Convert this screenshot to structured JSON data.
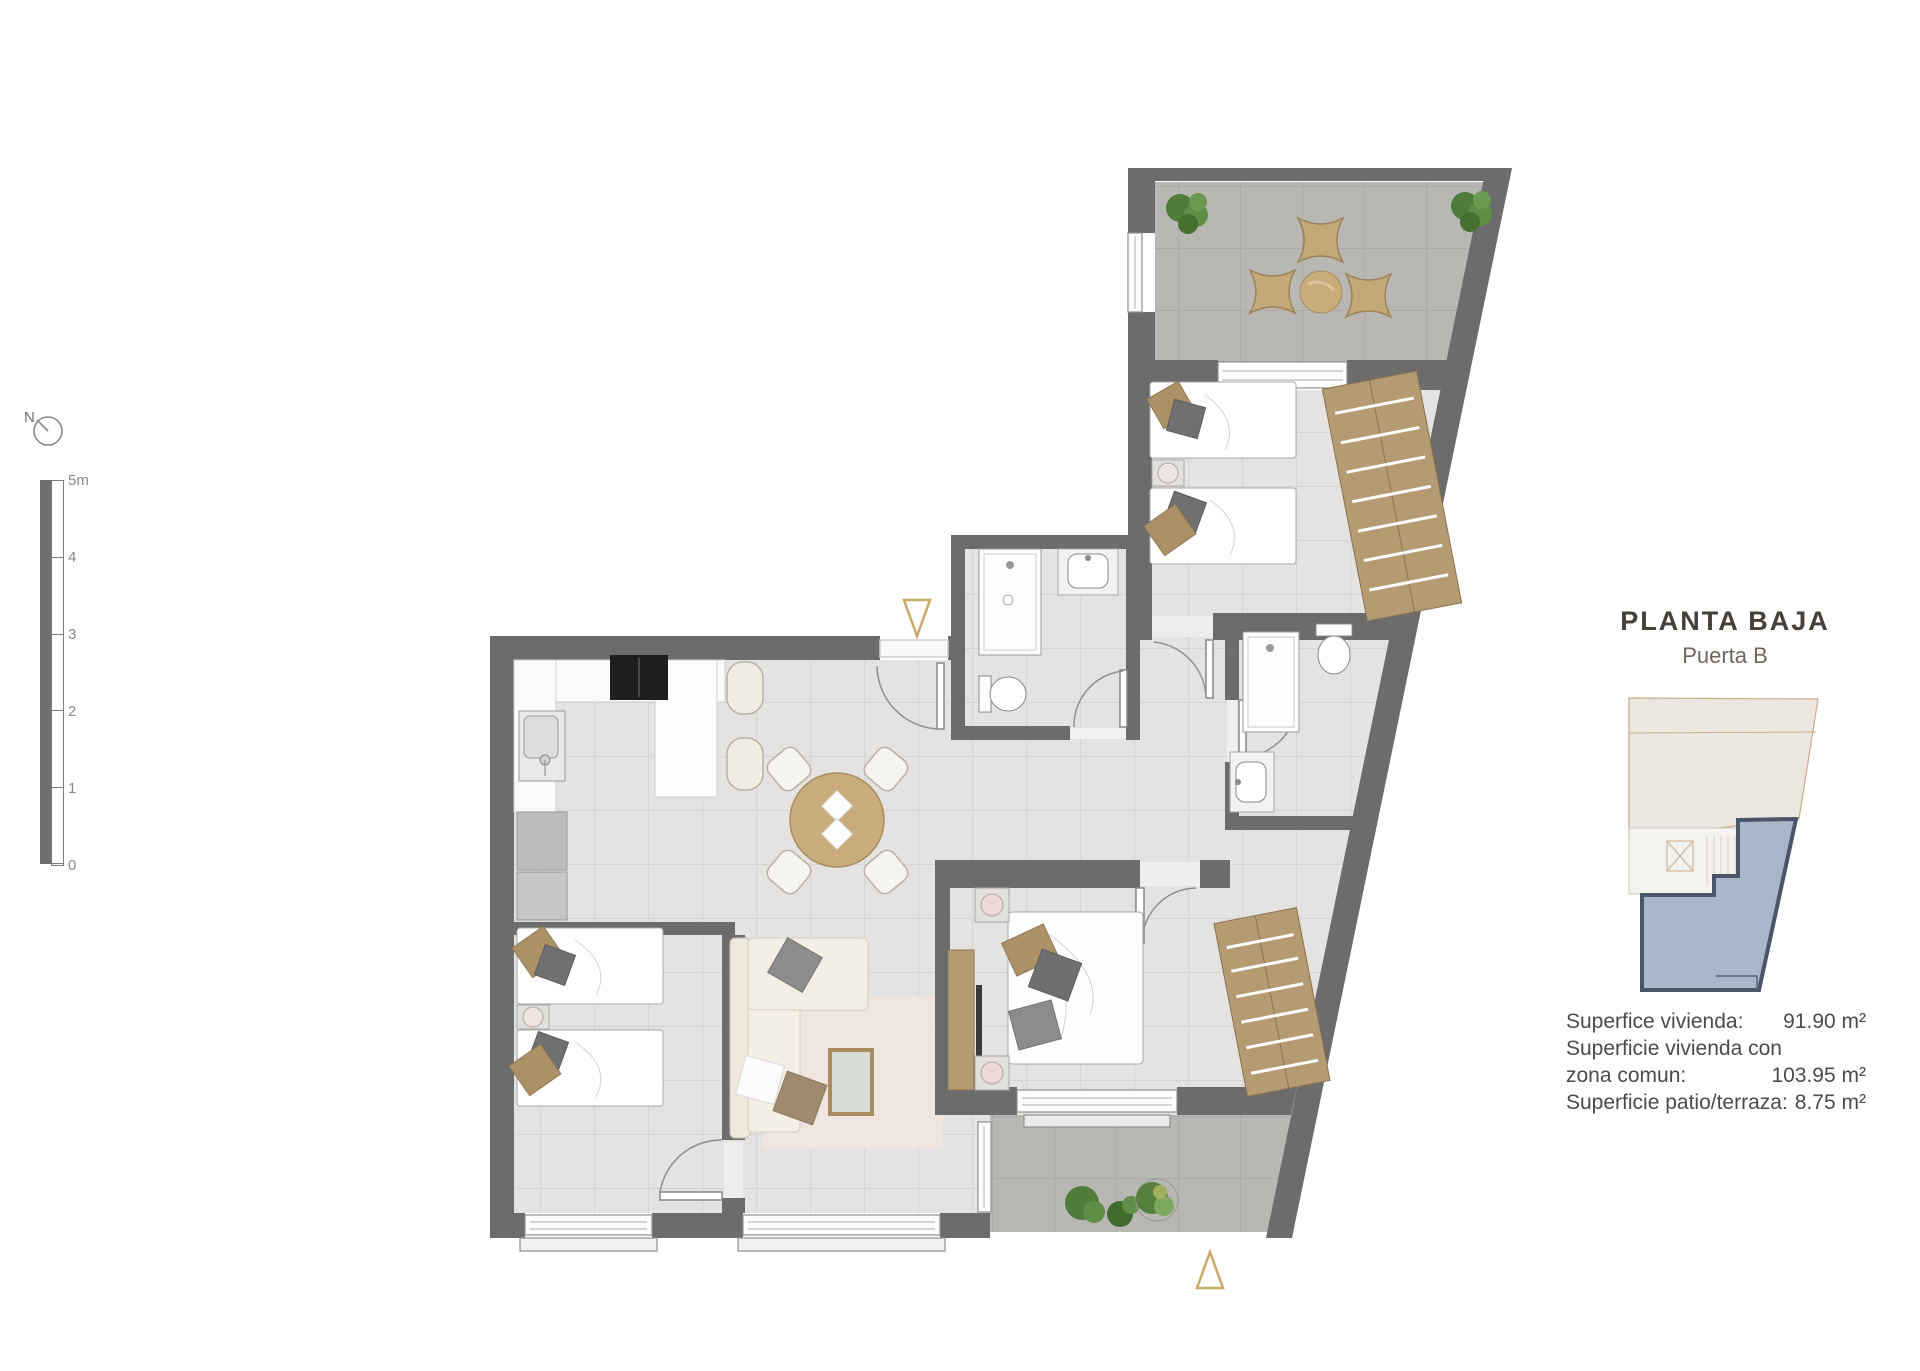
{
  "title": {
    "main": "PLANTA BAJA",
    "subtitle": "Puerta B"
  },
  "compass": {
    "label": "N"
  },
  "scale_bar": {
    "labels": [
      "5m",
      "4",
      "3",
      "2",
      "1",
      "0"
    ]
  },
  "areas": {
    "lines": [
      {
        "label": "Superfice vivienda:",
        "value": "91.90 m²"
      },
      {
        "label": "Superficie vivienda con",
        "value": ""
      },
      {
        "label": "zona comun:",
        "value": "103.95 m²"
      },
      {
        "label": "Superficie patio/terraza:",
        "value": "8.75 m²"
      }
    ]
  },
  "colors": {
    "wall": "#6c6c6c",
    "floor_tile": "#e4e3e1",
    "terrace_tile": "#b9b7b4",
    "wood": "#c9ab7c",
    "wardrobe": "#b59b72",
    "accent_triangle": "#c9a96a",
    "unit_highlight": "#a9b6ca",
    "unit_outline": "#4a5568",
    "title_color": "#45403a"
  }
}
